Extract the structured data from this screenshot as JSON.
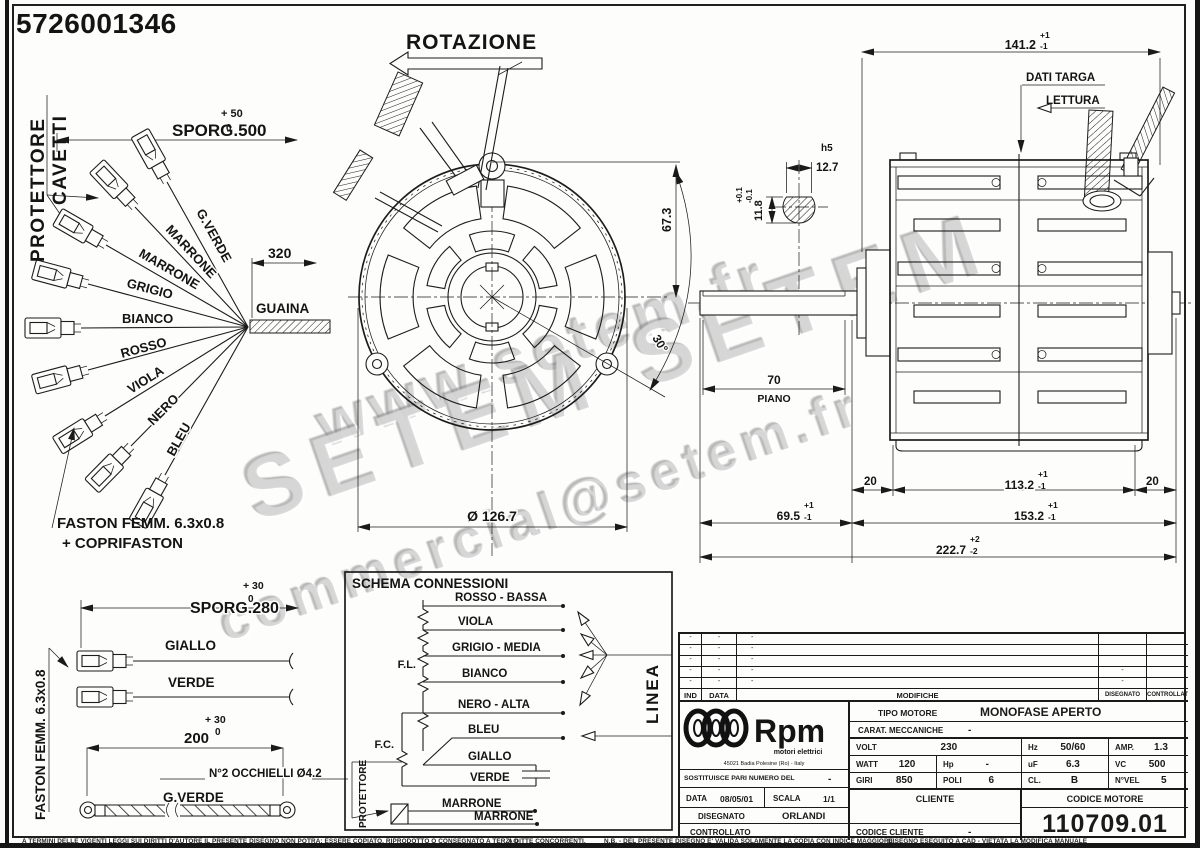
{
  "part_number": "5726001346",
  "upper_harness": {
    "protettore_line1": "PROTETTORE",
    "protettore_line2": "CAVETTI",
    "sporg_dim": "SPORG.500",
    "sporg_tol_plus": "+ 50",
    "sporg_tol_minus": "0",
    "dim_320": "320",
    "guaina": "GUAINA",
    "wire_gverde": "G.VERDE",
    "wire_marrone1": "MARRONE",
    "wire_marrone2": "MARRONE",
    "wire_grigio": "GRIGIO",
    "wire_bianco": "BIANCO",
    "wire_rosso": "ROSSO",
    "wire_viola": "VIOLA",
    "wire_nero": "NERO",
    "wire_bleu": "BLEU",
    "faston_note1": "FASTON FEMM. 6.3x0.8",
    "faston_note2": "+ COPRIFASTON"
  },
  "front_view": {
    "rotation": "ROTAZIONE",
    "diameter": "Ø 126.7",
    "height_67": "67.3",
    "angle_30": "30°"
  },
  "shaft_detail": {
    "fit": "h5",
    "width": "12.7",
    "height": "11.8",
    "tol_plus": "+0.1",
    "tol_minus": "-0.1",
    "flat_len": "70",
    "flat_label": "PIANO"
  },
  "side_view": {
    "dati_targa": "DATI TARGA",
    "lettura": "LETTURA",
    "len_141": "141.2",
    "tol_p1": "+1",
    "tol_m1": "-1",
    "tol_p2": "+2",
    "tol_m2": "-2",
    "dim_20l": "20",
    "dim_113": "113.2",
    "dim_20r": "20",
    "dim_69": "69.5",
    "dim_153": "153.2",
    "dim_222": "222.7"
  },
  "lower_harness": {
    "faston_side": "FASTON FEMM. 6.3x0.8",
    "sporg_dim": "SPORG.280",
    "sporg_tol_plus": "+ 30",
    "sporg_tol_minus": "0",
    "wire_giallo": "GIALLO",
    "wire_verde": "VERDE",
    "dim_200": "200",
    "dim_200_tol_plus": "+ 30",
    "dim_200_tol_minus": "0",
    "occhielli": "N°2 OCCHIELLI Ø4.2",
    "wire_gverde": "G.VERDE"
  },
  "schema": {
    "title": "SCHEMA CONNESSIONI",
    "fl": "F.L.",
    "fc": "F.C.",
    "protettore": "PROTETTORE",
    "linea": "LINEA",
    "w_rosso": "ROSSO - BASSA",
    "w_viola": "VIOLA",
    "w_grigio": "GRIGIO - MEDIA",
    "w_bianco": "BIANCO",
    "w_nero": "NERO - ALTA",
    "w_bleu": "BLEU",
    "w_giallo": "GIALLO",
    "w_verde": "VERDE",
    "w_marrone1": "MARRONE",
    "w_marrone2": "MARRONE"
  },
  "revision": {
    "h_ind": "IND",
    "h_data": "DATA",
    "h_mod": "MODIFICHE",
    "h_dis": "DISEGNATO",
    "h_con": "CONTROLLATO",
    "dash": "-"
  },
  "title_block": {
    "logo": "Rpm",
    "logo_sub": "motori elettrici",
    "logo_addr": "45021 Badia Polesine (Ro) - Italy",
    "tipo_label": "TIPO MOTORE",
    "tipo_value": "MONOFASE APERTO",
    "carat_label": "CARAT. MECCANICHE",
    "carat_value": "-",
    "volt_l": "VOLT",
    "volt_v": "230",
    "hz_l": "Hz",
    "hz_v": "50/60",
    "amp_l": "AMP.",
    "amp_v": "1.3",
    "watt_l": "WATT",
    "watt_v": "120",
    "hp_l": "Hp",
    "hp_v": "-",
    "uf_l": "uF",
    "uf_v": "6.3",
    "vc_l": "VC",
    "vc_v": "500",
    "giri_l": "GIRI",
    "giri_v": "850",
    "poli_l": "POLI",
    "poli_v": "6",
    "cl_l": "CL.",
    "cl_v": "B",
    "nvel_l": "N°VEL",
    "nvel_v": "5",
    "sost_label": "SOSTITUISCE PARI NUMERO DEL",
    "sost_value": "-",
    "data_l": "DATA",
    "data_v": "08/05/01",
    "scala_l": "SCALA",
    "scala_v": "1/1",
    "dis_l": "DISEGNATO",
    "dis_v": "ORLANDI",
    "con_l": "CONTROLLATO",
    "cliente_l": "CLIENTE",
    "cod_cli_l": "CODICE CLIENTE",
    "cod_cli_v": "-",
    "cod_mot_l": "CODICE MOTORE",
    "cod_mot_v": "110709.01"
  },
  "watermark": {
    "l1": "www.setem.fr",
    "l2": "SETEM  SETEM",
    "l3": "commercial@setem.fr"
  },
  "footer": {
    "t1": "A TERMINI DELLE VIGENTI LEGGI SUI DIRITTI D'AUTORE IL PRESENTE DISEGNO NON POTRA: ESSERE COPIATO, RIPRODOTTO O CONSEGNATO A TERZI O",
    "t2": "A DITTE CONCORRENTI.",
    "t3": "N.B. - DEL PRESENTE DISEGNO E' VALIDA SOLAMENTE LA COPIA CON INDICE MAGGIORE.",
    "t4": "DISEGNO ESEGUITO A CAD - VIETATA LA MODIFICA MANUALE"
  }
}
